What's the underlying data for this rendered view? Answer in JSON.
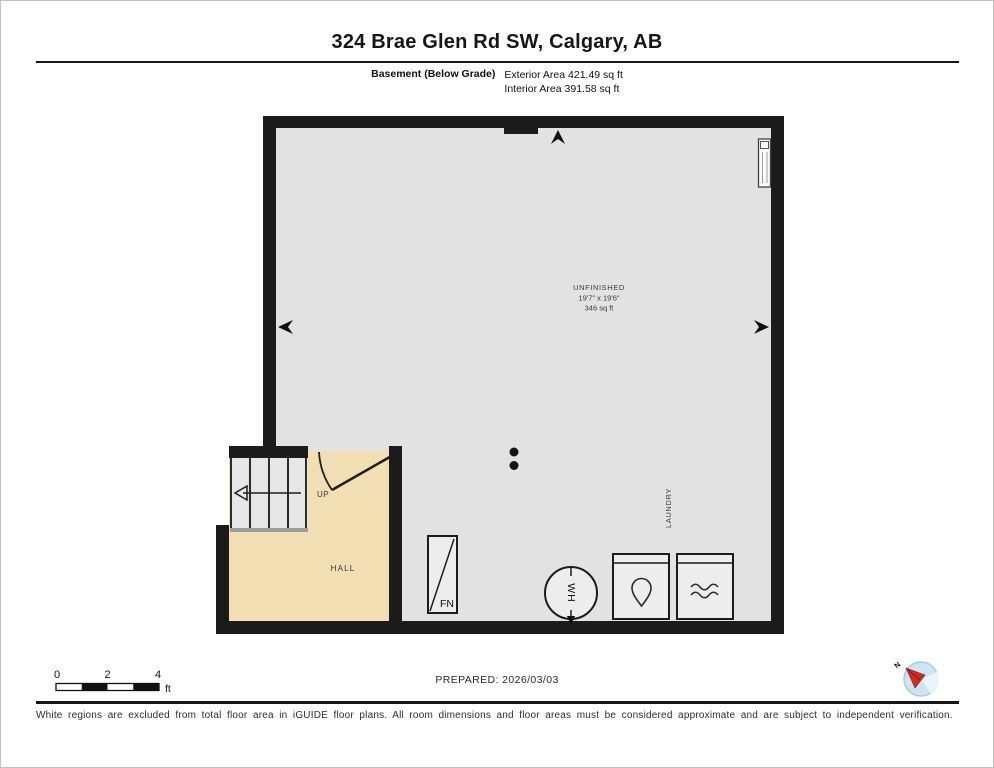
{
  "header": {
    "title": "324 Brae Glen Rd SW, Calgary, AB",
    "floor_label": "Basement (Below Grade)",
    "exterior_area": "Exterior Area 421.49 sq ft",
    "interior_area": "Interior Area 391.58 sq ft"
  },
  "plan": {
    "unfinished": {
      "name": "UNFINISHED",
      "dims": "19'7\" x 19'6\"",
      "area": "346 sq ft"
    },
    "hall_label": "HALL",
    "laundry_label": "LAUNDRY",
    "up_label": "UP",
    "furnace_label": "FN",
    "water_heater_label": "WH"
  },
  "scale_bar": {
    "tick0": "0",
    "tick2": "2",
    "tick4": "4",
    "unit": "ft"
  },
  "compass": {
    "north_label": "N"
  },
  "footer": {
    "prepared_label": "PREPARED: 2026/03/03",
    "disclaimer": "White regions are excluded from total floor area in iGUIDE floor plans. All room dimensions and floor areas must be considered approximate and are subject to independent verification."
  },
  "colors": {
    "wall": "#1b1b1b",
    "room_fill": "#e2e2e2",
    "hall_fill": "#f1deb2",
    "stair_fill": "#e7e7e7",
    "compass_fill": "#cde4f1",
    "compass_needle": "#cf2b24"
  }
}
